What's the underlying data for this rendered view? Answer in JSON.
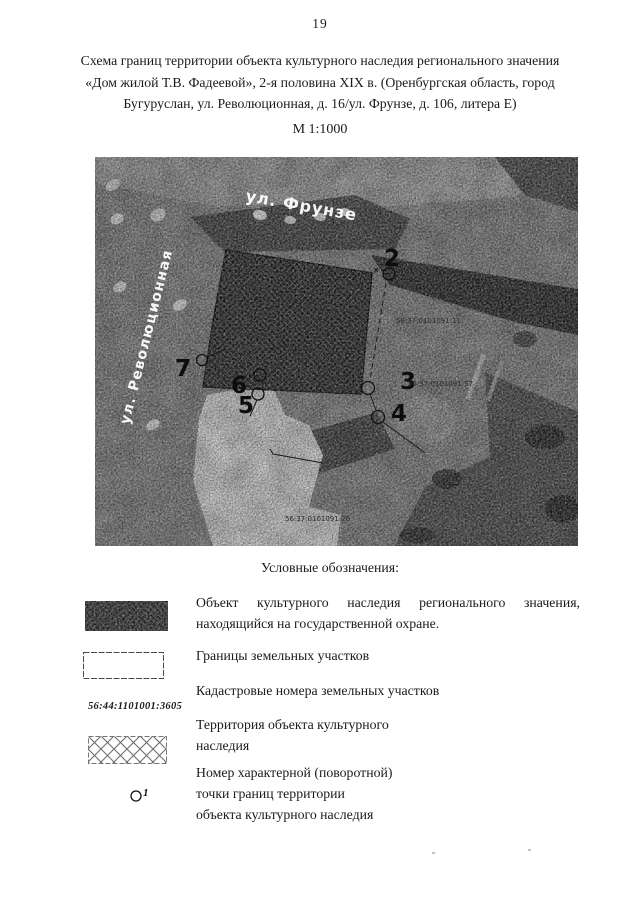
{
  "page_number": "19",
  "title_lines": [
    "Схема границ территории объекта культурного наследия регионального значения",
    "«Дом жилой Т.В. Фадеевой», 2-я половина XIX в. (Оренбургская область, город",
    "Бугуруслан, ул. Революционная, д. 16/ул. Фрунзе, д. 106, литера Е)"
  ],
  "scale_label": "М 1:1000",
  "map": {
    "street_labels": {
      "frunze": "ул. Фрунзе",
      "revolutsionnaya": "ул. Революционная"
    },
    "point_labels": [
      "2",
      "3",
      "4",
      "5",
      "6",
      "7"
    ],
    "cadastral_numbers": [
      "56:37:0101091:11",
      "56:37:0101091:57",
      "56:37:0101091:26",
      "56:37:0101091:14"
    ]
  },
  "legend": {
    "heading": "Условные обозначения:",
    "items": [
      {
        "id": "heritage-object",
        "lines": [
          "Объект культурного наследия регионального значения,",
          "находящийся на государственной охране."
        ]
      },
      {
        "id": "parcel-borders",
        "lines": [
          "Границы земельных участков"
        ]
      },
      {
        "id": "cadastral-numbers",
        "lines": [
          "Кадастровые номера земельных участков"
        ],
        "sample": "56:44:1101001:3605"
      },
      {
        "id": "heritage-territory",
        "lines": [
          "Территория объекта культурного",
          "наследия"
        ]
      },
      {
        "id": "turn-point",
        "symbol_digit": "1",
        "lines": [
          "Номер характерной (поворотной)",
          "точки границ территории",
          "объекта культурного наследия"
        ]
      }
    ]
  },
  "colors": {
    "paper": "#ffffff",
    "ink": "#1a1a1a",
    "map_base": "#8f8f8f"
  }
}
